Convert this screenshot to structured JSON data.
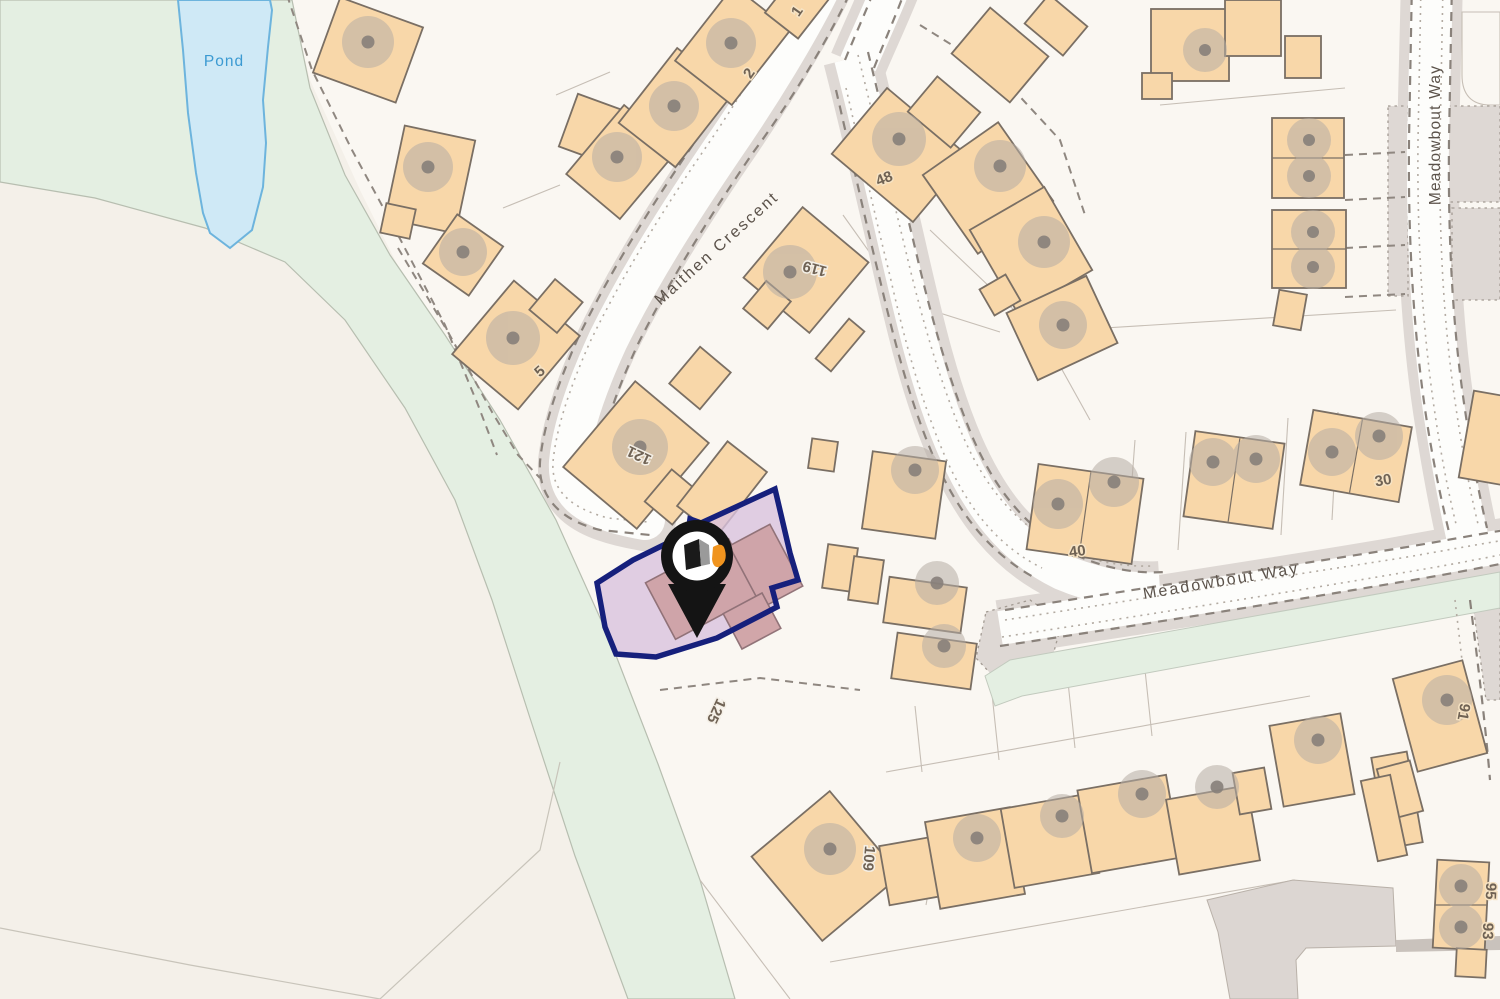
{
  "map": {
    "pond_label": "Pond",
    "street_labels": {
      "maithen": "Maithen Crescent",
      "meadowbout_vertical": "Meadowbout Way",
      "meadowbout_horizontal": "Meadowbout Way"
    },
    "house_numbers": {
      "n1": "1",
      "n2": "2",
      "n5": "5",
      "n48": "48",
      "n119": "119",
      "n121": "121",
      "n125": "125",
      "n109": "109",
      "n40": "40",
      "n30": "30",
      "n91": "91",
      "n95": "95",
      "n93": "93"
    },
    "marker": {
      "kind": "property-location-pin",
      "pin_color": "#141414",
      "logo_orange": "#f0941f"
    },
    "highlight": {
      "parcel_fill": "#d9c2dd",
      "parcel_border": "#16207c"
    },
    "colors": {
      "building": "#f8d7a9",
      "building_border": "#7a6f64",
      "road_verge": "#ded8d4",
      "field": "#f4f0e9",
      "estate": "#faf7f2",
      "green": "#e4efe2",
      "pond_fill": "#cfe9f6",
      "pond_border": "#6db4dd"
    }
  }
}
